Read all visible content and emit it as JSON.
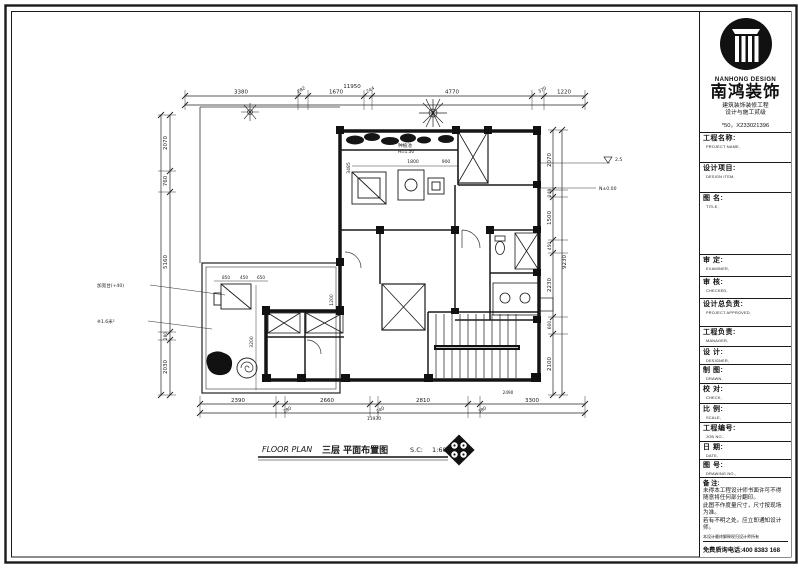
{
  "title_block": {
    "logo": {
      "brand_en": "NANHONG DESIGN",
      "brand_cn": "南鸿装饰",
      "cert_line1": "建筑装饰装修工程",
      "cert_line2": "设计与施工贰级",
      "cert_no": "*50，X233021396"
    },
    "fields": [
      {
        "cn": "工程名称:",
        "en": "PROJECT NAME,"
      },
      {
        "cn": "设计项目:",
        "en": "DESIGN ITEM,"
      },
      {
        "cn": "图  名:",
        "en": "TITLE,"
      },
      {
        "cn": "审  定:",
        "en": "EXAMINER,"
      },
      {
        "cn": "审  核:",
        "en": "CHECKED,"
      },
      {
        "cn": "设计总负责:",
        "en": "PROJECT APPROVED,"
      },
      {
        "cn": "工程负责:",
        "en": "MANAGER,"
      },
      {
        "cn": "设  计:",
        "en": "DESIGNER,"
      },
      {
        "cn": "制  图:",
        "en": "DRAWN,"
      },
      {
        "cn": "校  对:",
        "en": "CHECK,"
      },
      {
        "cn": "比  例:",
        "en": "SCALE,"
      },
      {
        "cn": "工程编号:",
        "en": "JOB NO.,"
      },
      {
        "cn": "日  期:",
        "en": "DATE,"
      },
      {
        "cn": "图  号:",
        "en": "DRAWING NO.,"
      }
    ],
    "notes": {
      "title": "备 注:",
      "lines": [
        "未得本工程设计师书面许可不得",
        "随意将任何部分翻印。",
        "此图不作度量尺寸，尺寸按现场",
        "为准。",
        "若有不明之处。应立即通知设计",
        "师。"
      ],
      "fine_print": "本设计最终解释权归设计师所有",
      "phone": "免费质询电话:400 8383 168"
    }
  },
  "plan": {
    "caption": {
      "prefix": "FLOOR PLAN",
      "title_cn": "三层 平面布置图",
      "scale_label": "S.C:",
      "scale_value": "1:60"
    },
    "dims": {
      "top": [
        "3380",
        "282",
        "1670",
        "244",
        "4770",
        "370",
        "1220"
      ],
      "top_overall": "11950",
      "bottom": [
        "2390",
        "280",
        "2660",
        "240",
        "2810",
        "380",
        "3300"
      ],
      "bottom_overall": "11930",
      "left": [
        "2070",
        "760",
        "5160",
        "280",
        "2030"
      ],
      "right": [
        "2070",
        "240",
        "1500",
        "450",
        "2230",
        "600",
        "2100"
      ],
      "right_overall": "9230",
      "interior": [
        "3485",
        "1800",
        "900",
        "850",
        "450",
        "650",
        "3200",
        "2490",
        "1200"
      ]
    },
    "annotations": {
      "left1": "加宽台(+40)",
      "left2": "※1.6米²",
      "level1": "2.5",
      "level2": "N±0.00",
      "planter_name": "种植池",
      "planter_level": "H=1.50"
    }
  }
}
